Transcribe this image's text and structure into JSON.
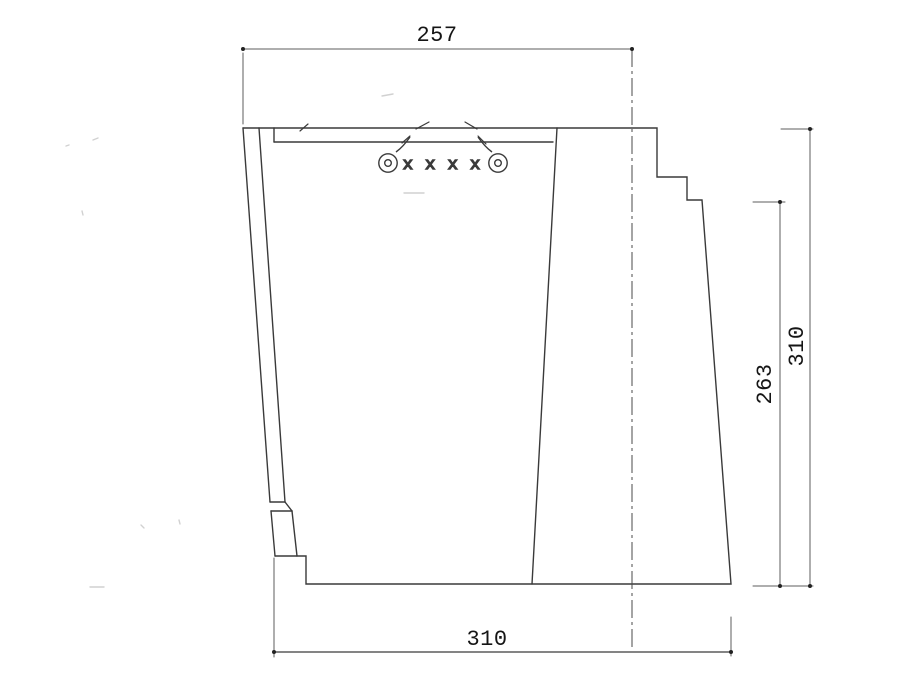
{
  "page": {
    "background": "#ffffff",
    "description": "CAD cross-section drawing with dimensions"
  },
  "drawing": {
    "type": "technical-cross-section",
    "dims": {
      "top_width": "257",
      "bottom_width": "310",
      "right_height_inner": "263",
      "right_height_outer": "310"
    },
    "annotations": {
      "fastener_row": "x x x x"
    },
    "colors": {
      "outline": "#3a3a3a",
      "dimension": "#5c5c5c",
      "centerline": "#4a4a4a",
      "terminator": "#222222",
      "text": "#151515"
    }
  }
}
